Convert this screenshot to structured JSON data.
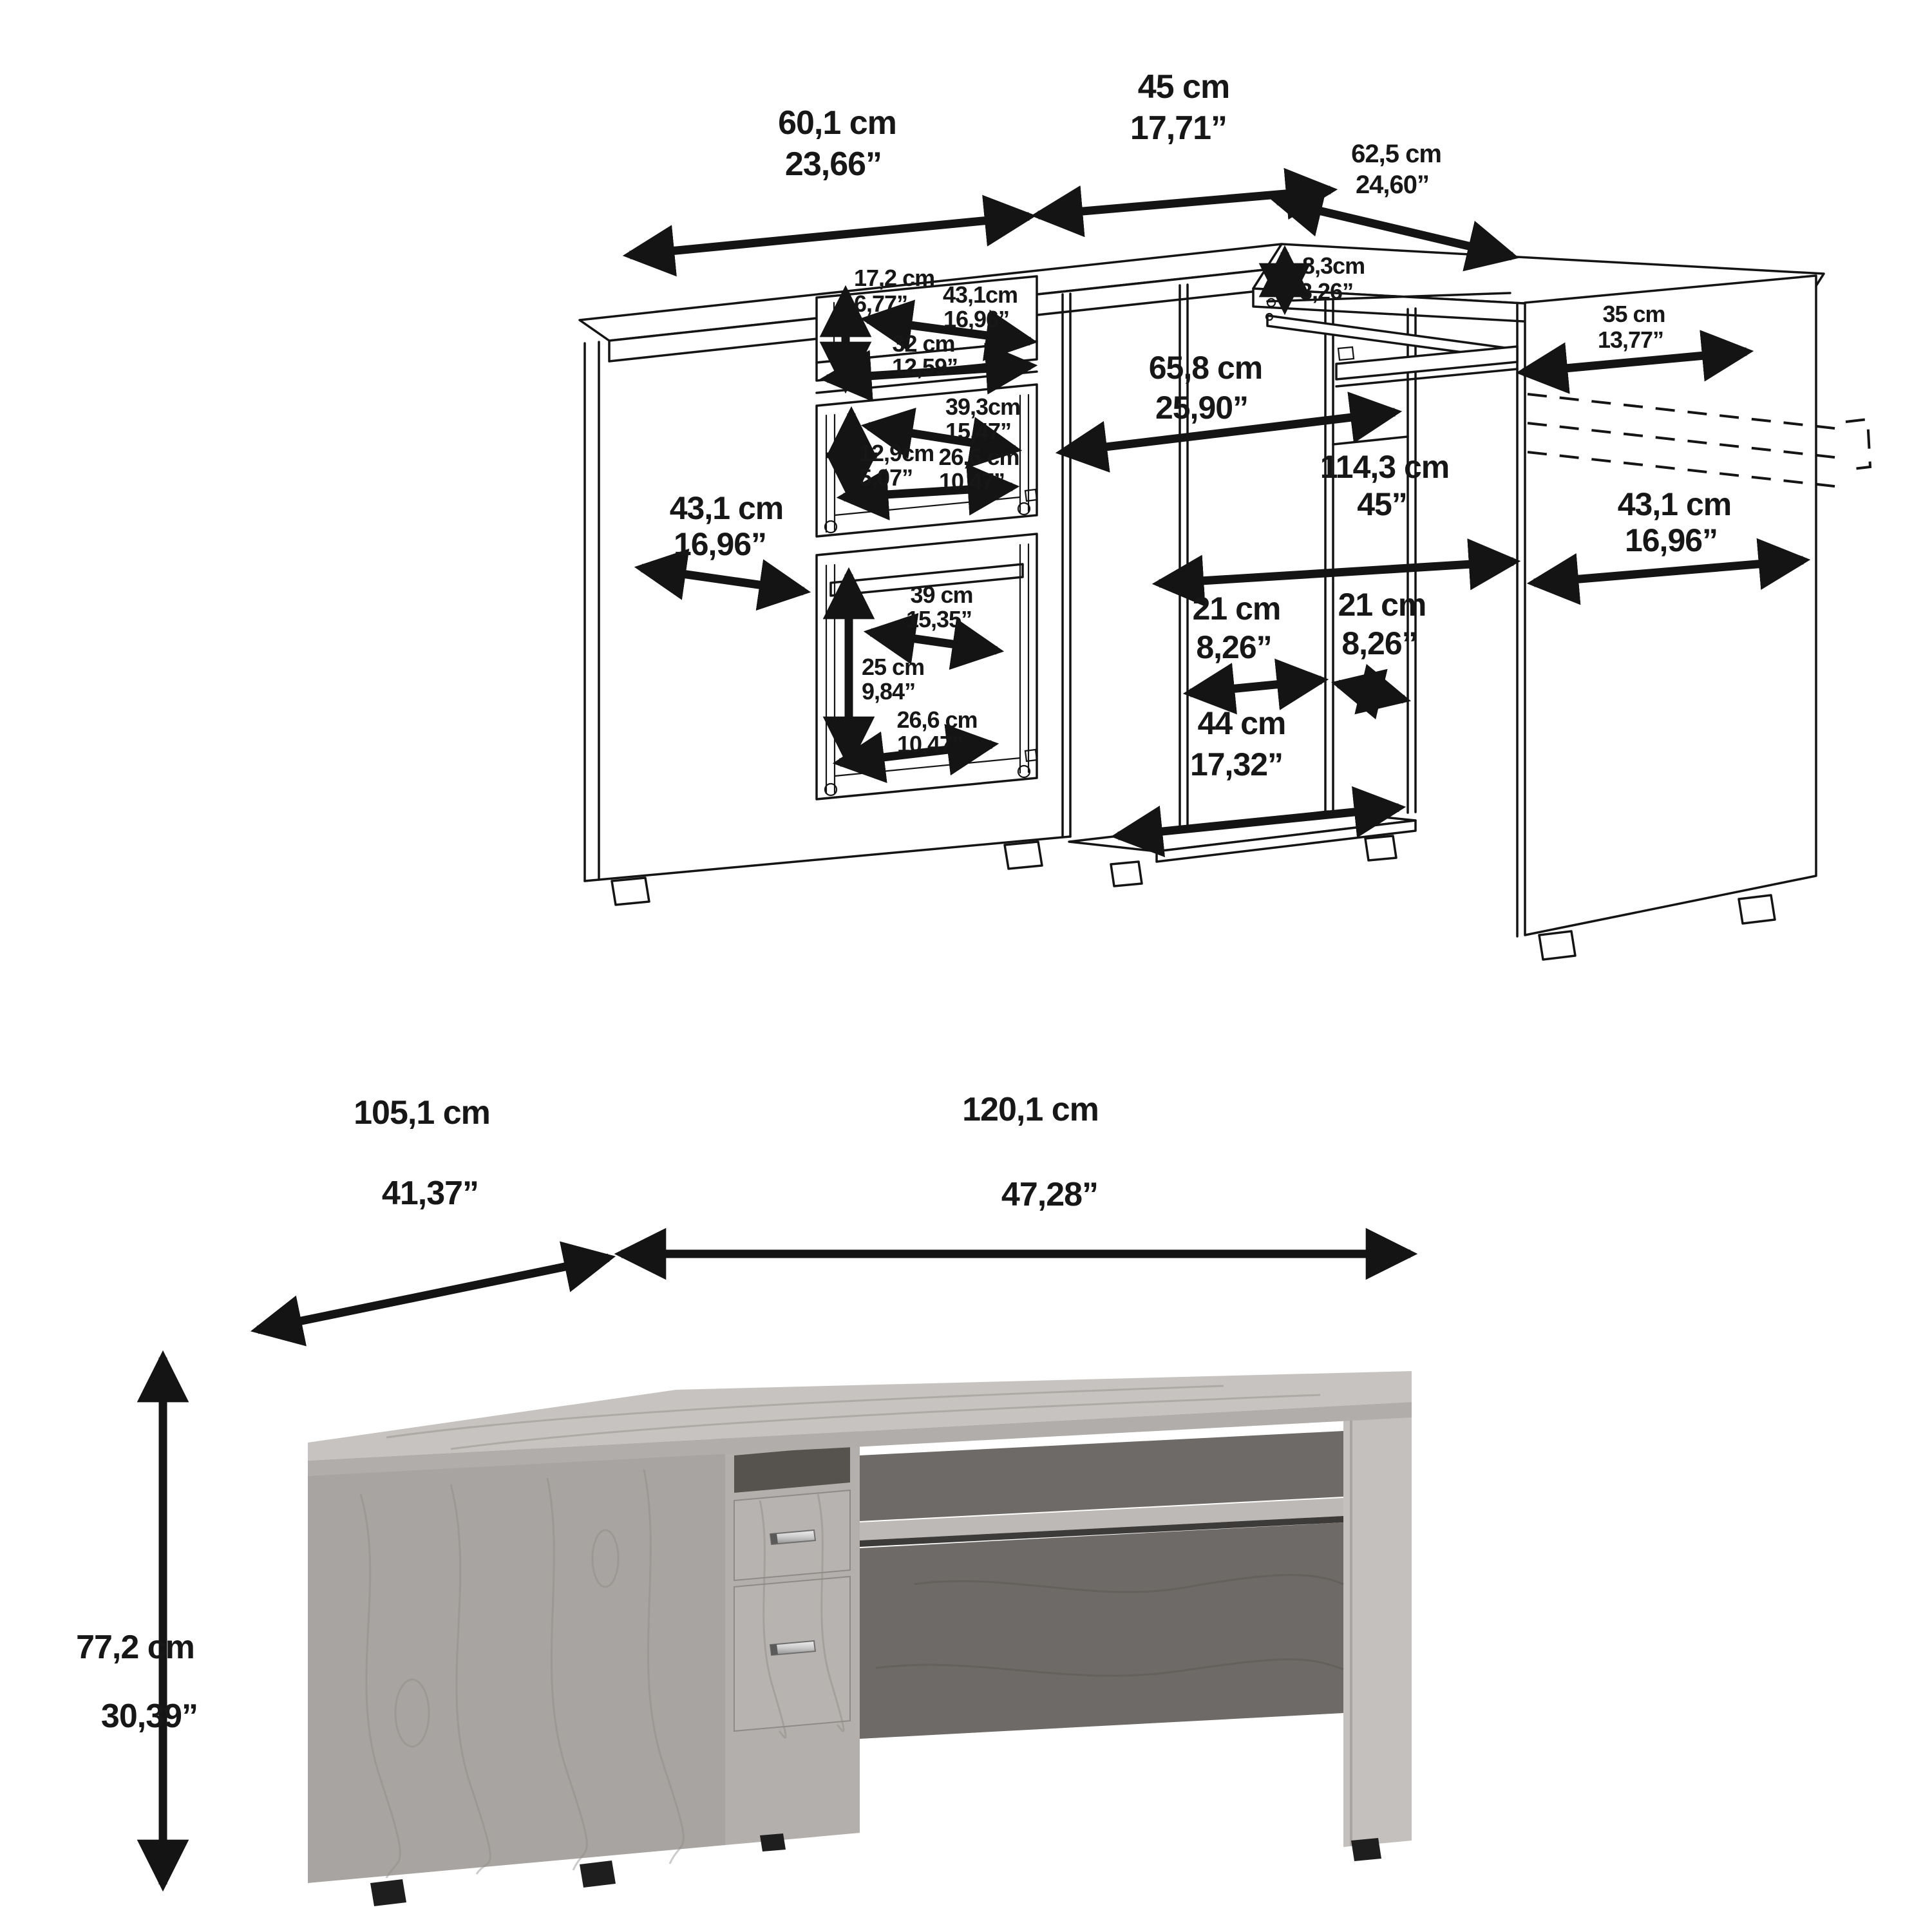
{
  "figure": {
    "description": "Corner computer desk dimension sheet: technical wireframe with dimension arrows (top) and gray-wood product render with overall dimensions (bottom)"
  },
  "drawing_dims": {
    "left_top_width": {
      "cm": "60,1 cm",
      "in": "23,66”"
    },
    "corner_width": {
      "cm": "45 cm",
      "in": "17,71”"
    },
    "right_top_depth": {
      "cm": "62,5 cm",
      "in": "24,60”"
    },
    "tray_clearance": {
      "cm": "8,3cm",
      "in": "3,26”"
    },
    "tray_extension": {
      "cm": "35 cm",
      "in": "13,77”"
    },
    "hutch_height": {
      "cm": "17,2 cm",
      "in": "6,77”"
    },
    "hutch_width_back": {
      "cm": "43,1cm",
      "in": "16,96”"
    },
    "hutch_width_front": {
      "cm": "32 cm",
      "in": "12,59”"
    },
    "knee_width": {
      "cm": "65,8 cm",
      "in": "25,90”"
    },
    "mid_drawer_width": {
      "cm": "39,3cm",
      "in": "15,47”"
    },
    "mid_drawer_height": {
      "cm": "12,9cm",
      "in": "5,07”"
    },
    "mid_drawer_depth": {
      "cm": "26,6 cm",
      "in": "10,47”"
    },
    "left_side_depth": {
      "cm": "43,1 cm",
      "in": "16,96”"
    },
    "overall_width": {
      "cm": "114,3 cm",
      "in": "45”"
    },
    "right_side_depth": {
      "cm": "43,1 cm",
      "in": "16,96”"
    },
    "bottom_drawer_width": {
      "cm": "39 cm",
      "in": "15,35”"
    },
    "bottom_drawer_height": {
      "cm": "25 cm",
      "in": "9,84”"
    },
    "bottom_drawer_depth": {
      "cm": "26,6 cm",
      "in": "10,47”"
    },
    "gap_left": {
      "cm": "21 cm",
      "in": "8,26”"
    },
    "gap_right": {
      "cm": "21 cm",
      "in": "8,26”"
    },
    "base_width": {
      "cm": "44 cm",
      "in": "17,32”"
    }
  },
  "render_dims": {
    "depth": {
      "cm": "105,1 cm",
      "in": "41,37”"
    },
    "width": {
      "cm": "120,1 cm",
      "in": "47,28”"
    },
    "height": {
      "cm": "77,2 cm",
      "in": "30,39”"
    }
  },
  "colors": {
    "line": "#141414",
    "desktop_top": "#c6c3c0",
    "desktop_edge": "#b0adaa",
    "pedestal_face": "#a8a4a1",
    "column_face": "#b3afac",
    "drawer_front": "#b7b3b0",
    "notch_dark": "#56534f",
    "dark_panel": "#6e6a67",
    "tray_top": "#bcb9b6",
    "tray_shadow": "#3d3b39",
    "leg_face": "#c3c0bd",
    "foot_black": "#1e1e1e",
    "chrome": "#d8d8d8"
  }
}
